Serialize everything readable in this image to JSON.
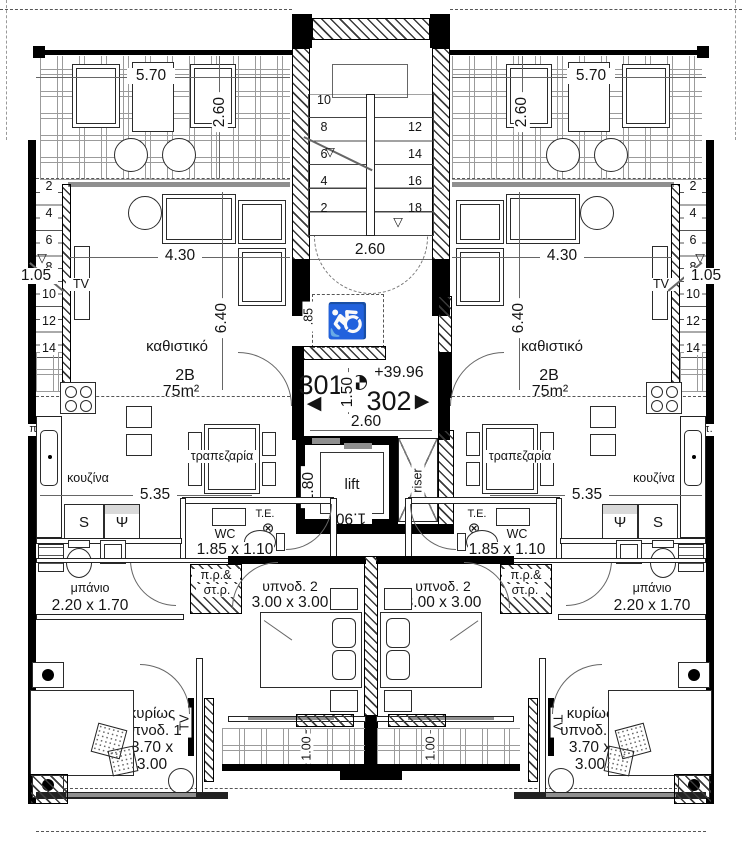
{
  "drawing": {
    "units": {
      "left": "301",
      "right": "302",
      "elevation": "+39.96",
      "type": "2B",
      "area": "75m²"
    },
    "rooms": {
      "living": "καθιστικό",
      "kitchen": "κουζίνα",
      "dining": "τραπεζαρία",
      "bath": "μπάνιο",
      "wc": "WC",
      "bed2": "υπνοδ. 2",
      "master_line1": "κυρίως",
      "master_line2": "υπνοδ. 1",
      "lift": "lift",
      "riser": "riser"
    },
    "dims": {
      "balcony_w": "5.70",
      "balcony_d": "2.60",
      "living_w": "4.30",
      "living_d": "6.40",
      "kitchen_w": "5.35",
      "stair_w": "2.60",
      "hall_w": "2.60",
      "hall_d": "1.50",
      "lift_d": "1.80",
      "lift_w": "1.90",
      "entry": "1.05",
      "ramp": ".85",
      "bath": "2.20 x 1.70",
      "wc": "1.85 x 1.10",
      "bed2": "3.00 x 3.00",
      "master1": "3.70 x",
      "master2": "3.00",
      "small_balcony": "1.00"
    },
    "tags": {
      "tv": "TV",
      "te": "T.E.",
      "s": "S",
      "psi": "Ψ",
      "pp": "π.π.",
      "shaft1": "π.ρ.&",
      "shaft2": "στ.ρ."
    },
    "stairs": {
      "main_left": [
        "10",
        "8",
        "6",
        "4",
        "2"
      ],
      "main_right": [
        "12",
        "14",
        "16",
        "18"
      ],
      "side": [
        "2",
        "4",
        "6",
        "8",
        "10",
        "12",
        "14"
      ]
    },
    "icons": {
      "wheelchair": "♿",
      "level": "▽",
      "arrow_left": "◀",
      "arrow_right": "▶",
      "circled_x": "⊗"
    },
    "colors": {
      "wall": "#000000",
      "line": "#555555",
      "hatch": "#444444"
    }
  }
}
